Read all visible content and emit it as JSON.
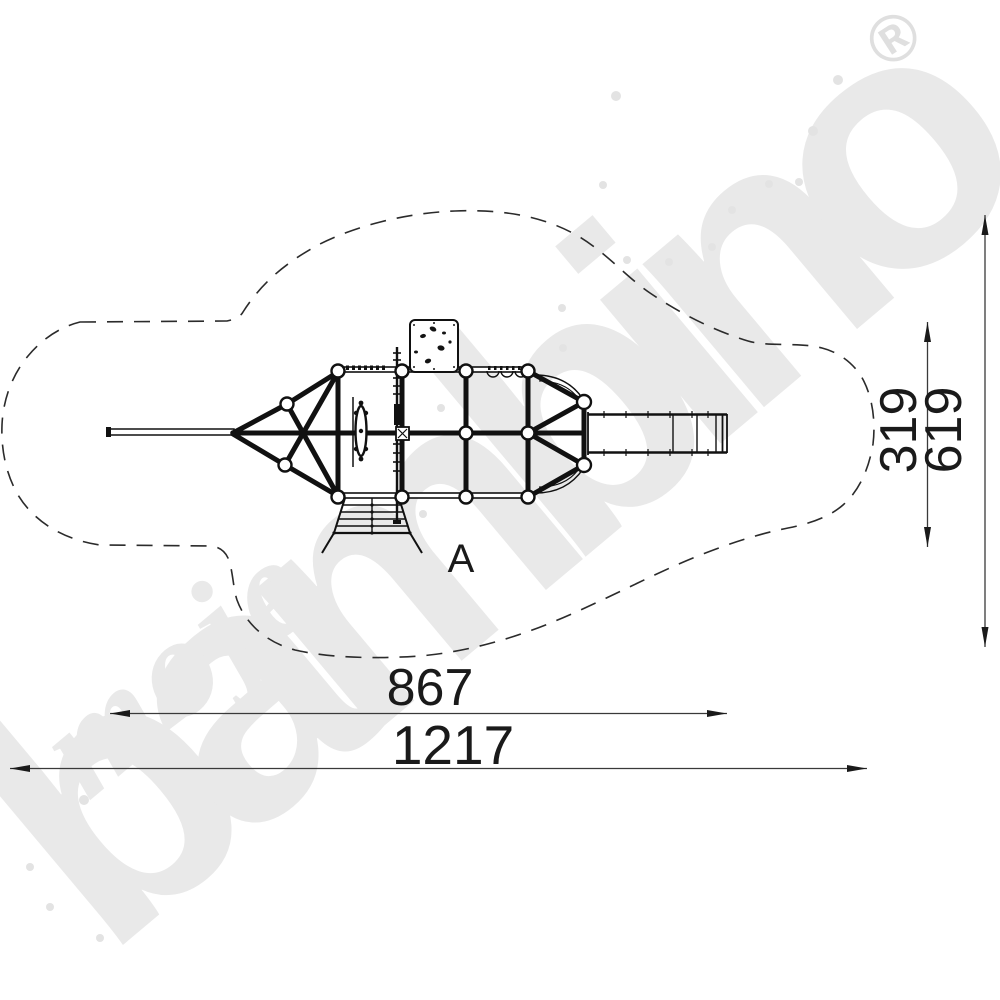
{
  "watermark": {
    "word_script": "moje",
    "word_main": "bambino",
    "registered": "®",
    "color": "#e9e9e9"
  },
  "drawing": {
    "view_label": "A",
    "dim_structure_width": "867",
    "dim_total_width": "1217",
    "dim_structure_height": "319",
    "dim_total_height": "619",
    "line_color": "#111111"
  }
}
